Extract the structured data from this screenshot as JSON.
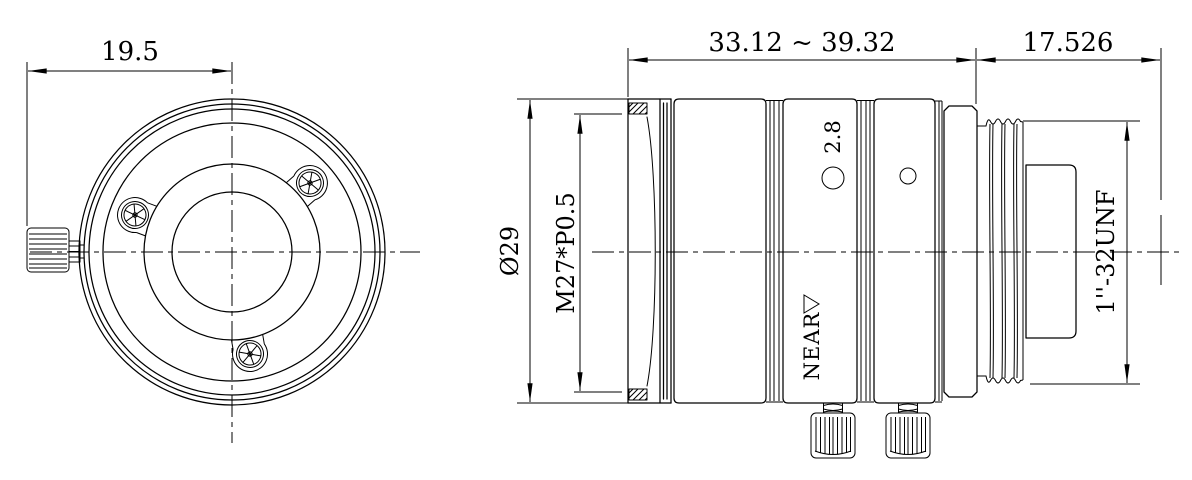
{
  "drawing": {
    "type": "lens mechanical drawing, front and side orthographic views",
    "colors": {
      "line": "#000000",
      "bg": "#ffffff"
    },
    "icons": {
      "near_direction": "right-triangle",
      "set_screw_head": "cross-knurled-circle",
      "thumbscrew": "knurled-grip"
    }
  },
  "labels": {
    "front_offset": "19.5",
    "body_length_range": "33.12 ~ 39.32",
    "flange_focal_distance": "17.526",
    "outer_diameter": "Ø29",
    "filter_thread": "M27*P0.5",
    "mount_thread": "1''-32UNF",
    "aperture_marking": "2.8",
    "near_label": "NEAR"
  }
}
